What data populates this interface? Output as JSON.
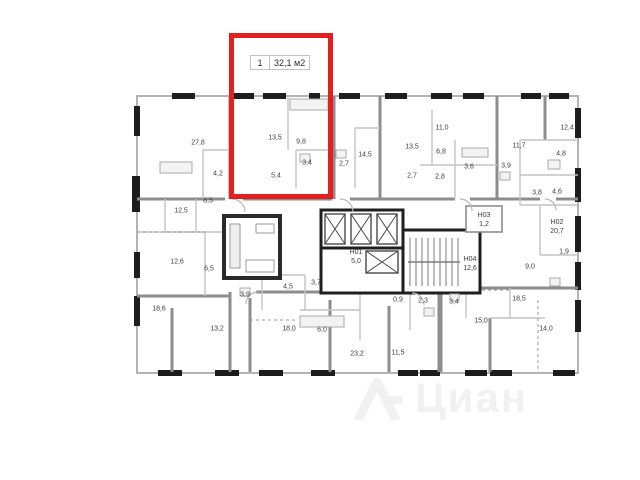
{
  "highlight": {
    "unit_number": "1",
    "unit_area": "32,1 м2",
    "outline_color": "#e3201f"
  },
  "watermark": {
    "brand": "Циан"
  },
  "plan": {
    "description": "Residential floor plan with one apartment highlighted",
    "room_labels": [
      {
        "t": "27,8",
        "x": 198,
        "y": 143
      },
      {
        "t": "13,5",
        "x": 275,
        "y": 138
      },
      {
        "t": "9,8",
        "x": 301,
        "y": 142
      },
      {
        "t": "3,4",
        "x": 307,
        "y": 163
      },
      {
        "t": "5,4",
        "x": 276,
        "y": 176
      },
      {
        "t": "4,2",
        "x": 218,
        "y": 174
      },
      {
        "t": "8,5",
        "x": 208,
        "y": 201
      },
      {
        "t": "12,5",
        "x": 181,
        "y": 211
      },
      {
        "t": "14,5",
        "x": 365,
        "y": 155
      },
      {
        "t": "2,7",
        "x": 344,
        "y": 164
      },
      {
        "t": "13,5",
        "x": 412,
        "y": 147
      },
      {
        "t": "2,7",
        "x": 412,
        "y": 176
      },
      {
        "t": "11,0",
        "x": 442,
        "y": 128
      },
      {
        "t": "6,8",
        "x": 441,
        "y": 152
      },
      {
        "t": "2,8",
        "x": 440,
        "y": 177
      },
      {
        "t": "3,6",
        "x": 469,
        "y": 167
      },
      {
        "t": "11,7",
        "x": 519,
        "y": 146
      },
      {
        "t": "3,9",
        "x": 506,
        "y": 166
      },
      {
        "t": "12,4",
        "x": 567,
        "y": 128
      },
      {
        "t": "4,8",
        "x": 561,
        "y": 154
      },
      {
        "t": "3,8",
        "x": 537,
        "y": 193
      },
      {
        "t": "4,6",
        "x": 557,
        "y": 192
      },
      {
        "t": "12,6",
        "x": 177,
        "y": 262
      },
      {
        "t": "6,5",
        "x": 209,
        "y": 269
      },
      {
        "t": "18,6",
        "x": 159,
        "y": 309
      },
      {
        "t": "3,9",
        "x": 245,
        "y": 295
      },
      {
        "t": "4,5",
        "x": 288,
        "y": 287
      },
      {
        "t": "3,7",
        "x": 316,
        "y": 283
      },
      {
        "t": "13,2",
        "x": 217,
        "y": 329
      },
      {
        "t": "18,0",
        "x": 289,
        "y": 329
      },
      {
        "t": "6,0",
        "x": 322,
        "y": 330
      },
      {
        "t": "23,2",
        "x": 357,
        "y": 354
      },
      {
        "t": "11,5",
        "x": 398,
        "y": 353
      },
      {
        "t": "0,9",
        "x": 398,
        "y": 300
      },
      {
        "t": "2,3",
        "x": 423,
        "y": 301
      },
      {
        "t": "Н01\n5,0",
        "x": 356,
        "y": 257
      },
      {
        "t": "Н03\n1,2",
        "x": 484,
        "y": 220
      },
      {
        "t": "Н04\n12,6",
        "x": 470,
        "y": 264
      },
      {
        "t": "Н02\n20,7",
        "x": 557,
        "y": 227
      },
      {
        "t": "9,0",
        "x": 530,
        "y": 267
      },
      {
        "t": "1,9",
        "x": 564,
        "y": 252
      },
      {
        "t": "3,4",
        "x": 454,
        "y": 302
      },
      {
        "t": "15,0",
        "x": 481,
        "y": 321
      },
      {
        "t": "18,5",
        "x": 519,
        "y": 299
      },
      {
        "t": "14,0",
        "x": 546,
        "y": 329
      }
    ]
  }
}
